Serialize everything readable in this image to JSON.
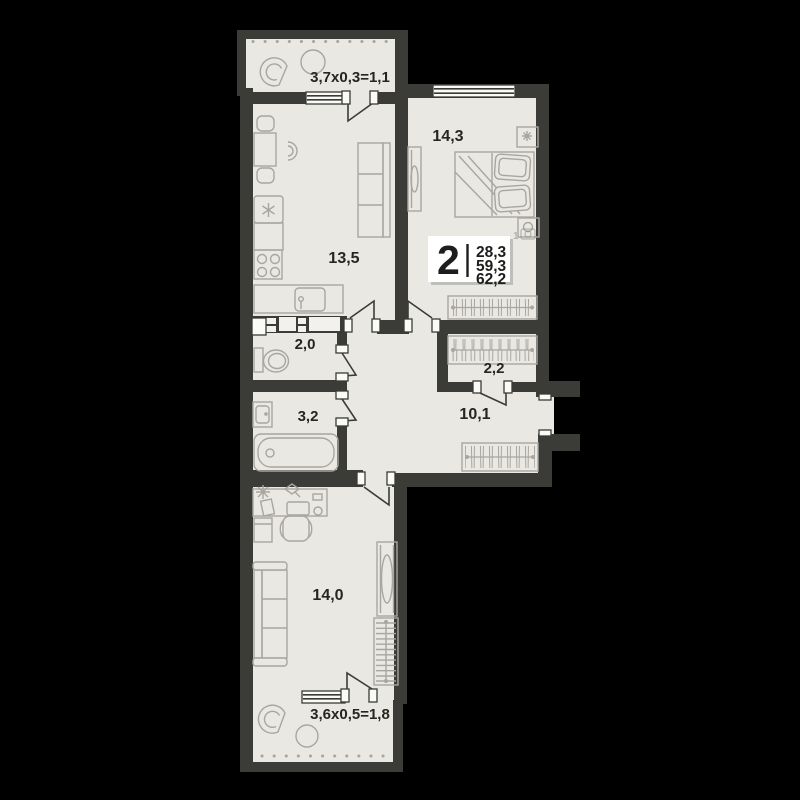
{
  "badge": {
    "rooms": "2",
    "values": [
      "28,3",
      "59,3",
      "62,2"
    ],
    "photo_count": "1"
  },
  "rooms": {
    "balcony_top": {
      "label": "3,7x0,3=1,1"
    },
    "bedroom": {
      "area": "14,3"
    },
    "kitchen_living": {
      "area": "13,5"
    },
    "wc": {
      "area": "2,0"
    },
    "bathroom": {
      "area": "3,2"
    },
    "wardrobe": {
      "area": "2,2"
    },
    "hallway": {
      "area": "10,1"
    },
    "room": {
      "area": "14,0"
    },
    "balcony_bottom": {
      "label": "3,6x0,5=1,8"
    }
  },
  "colors": {
    "background": "#000000",
    "wall": "#3b3b37",
    "floor": "#e9e8e3",
    "furniture": "#a8a69f",
    "text": "#26261f",
    "badge_bg": "#ffffff"
  }
}
